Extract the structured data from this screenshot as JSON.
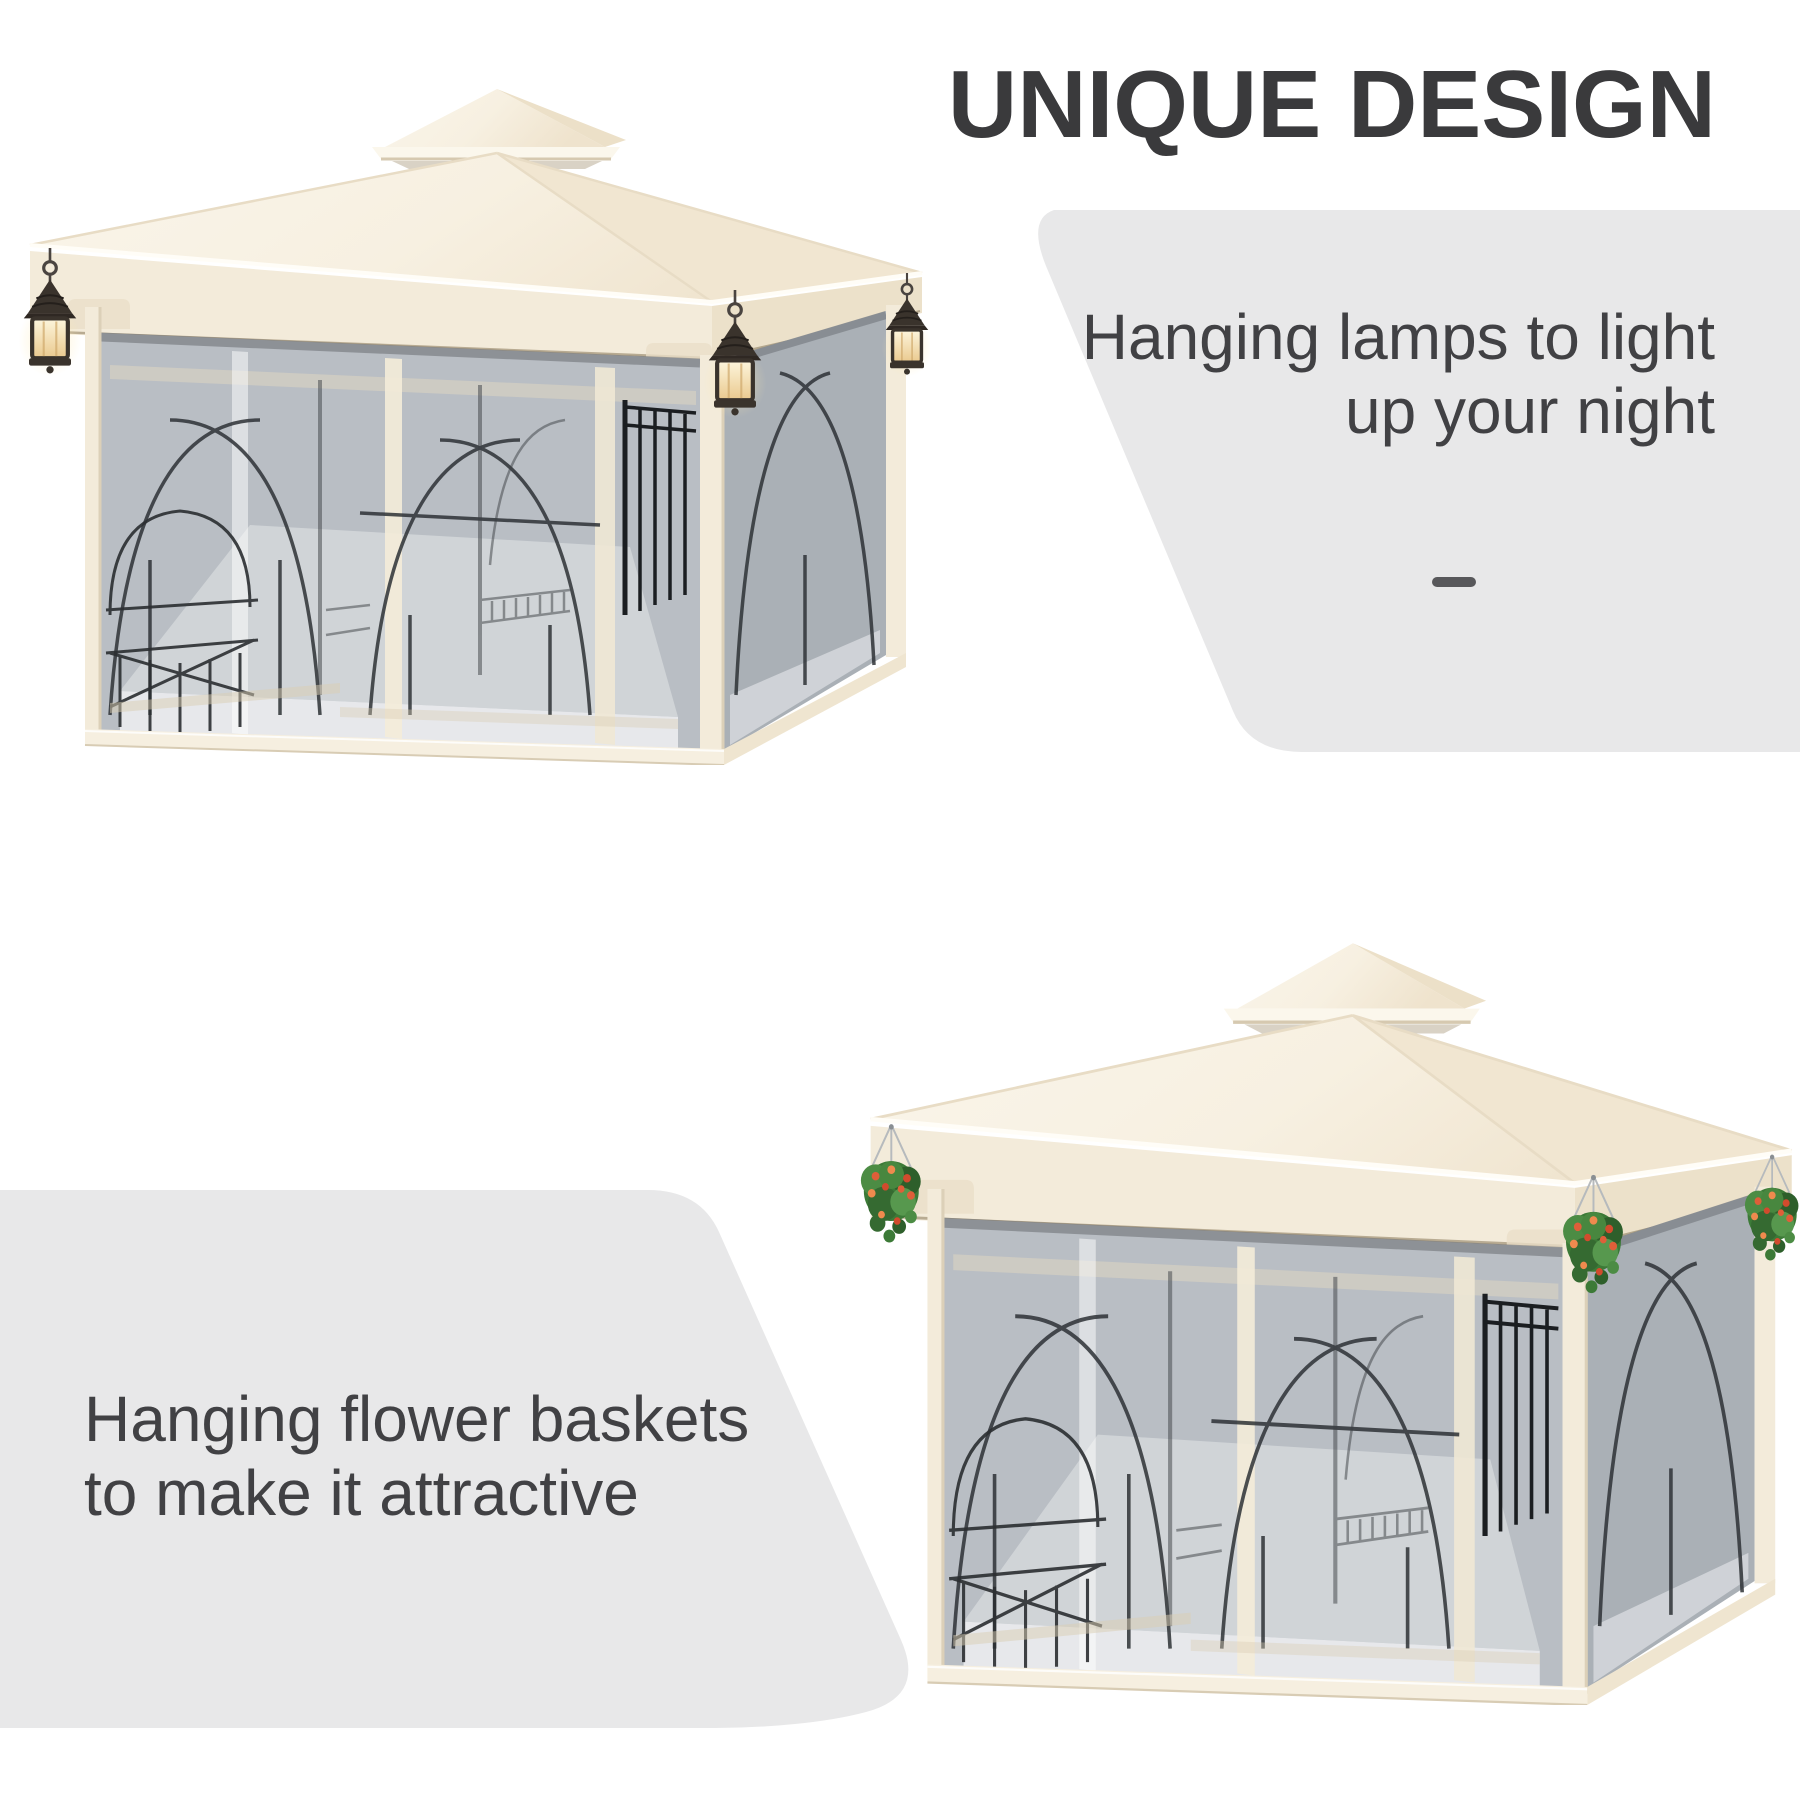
{
  "title": {
    "text": "UNIQUE DESIGN"
  },
  "features": {
    "lamps": {
      "line1": "Hanging lamps to light",
      "line2": "up your night"
    },
    "baskets": {
      "line1": "Hanging flower baskets",
      "line2": "to make it attractive"
    }
  },
  "decor": {
    "dash": "—"
  },
  "illustrations": {
    "top": "gazebo-with-hanging-lamps",
    "bottom": "gazebo-with-flower-baskets"
  },
  "colors": {
    "panel": "#e8e8e9",
    "heading": "#3a3a3c",
    "body_text": "#414144",
    "dash": "#58585b",
    "canopy": "#f8f2e5",
    "canopy_shade": "#f0e5d0",
    "frame_cream": "#f3ebda",
    "mesh": "#b9bec4",
    "ironwork": "#2e3236",
    "lantern_glow": "#f5e2b0",
    "foliage": "#3c7a37",
    "flower": "#df5f39"
  }
}
